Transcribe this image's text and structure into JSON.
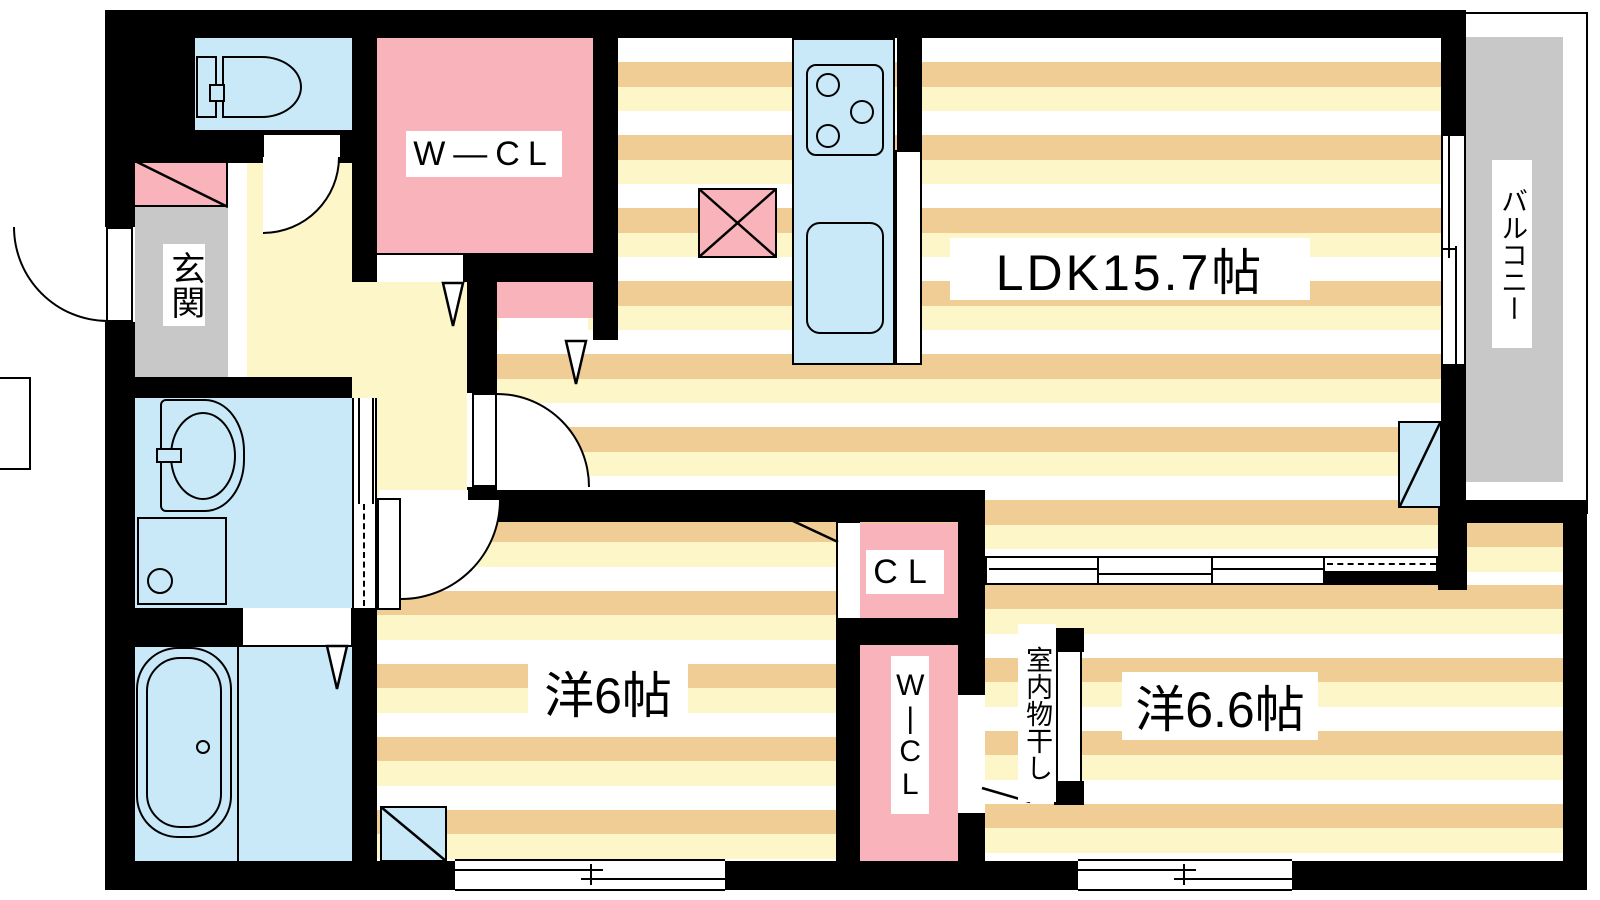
{
  "floor_plan": {
    "rooms": {
      "ldk": "LDK15.7帖",
      "western_room_6": "洋6帖",
      "western_room_66": "洋6.6帖",
      "walk_in_closet": "W—CL",
      "closet": "CL",
      "wic_vertical": "W|CL",
      "entrance": "玄関",
      "balcony": "バルコニー",
      "indoor_laundry": "室内物干し"
    },
    "colors": {
      "wall": "#000000",
      "floor_stripe_tan": "#f1cd96",
      "floor_stripe_cream": "#fdf6c9",
      "hallway_floor": "#fdf6c9",
      "closet_pink": "#f8b4ba",
      "fixture_blue": "#c9e9f9",
      "entrance_gray": "#c8c8c8",
      "balcony_gray": "#c8c8c8"
    }
  }
}
